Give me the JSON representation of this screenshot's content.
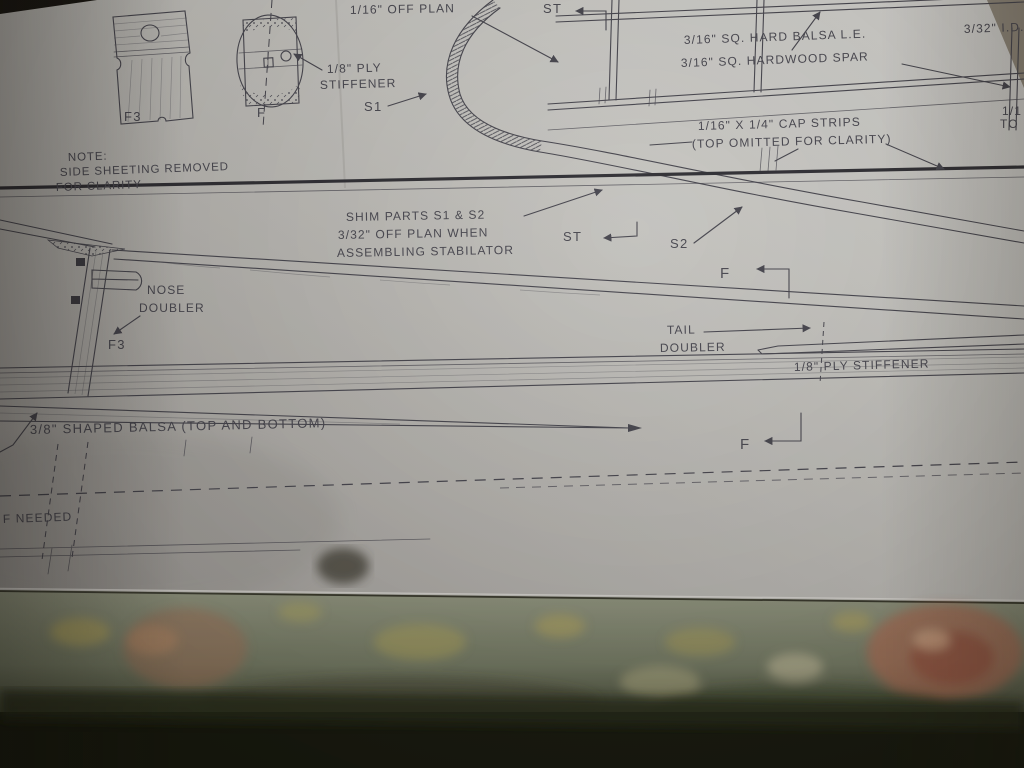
{
  "colors": {
    "paper": "#b8b6b2",
    "ink": "#45444d",
    "heavy_line": "#2b2a30",
    "tablecloth_sage": "#7f8570",
    "rose_rust": "#a5674e",
    "floral_yellow": "#b3a458",
    "background_dark": "#14160c"
  },
  "plan": {
    "parts": {
      "f3_label": "F3",
      "f_label": "F"
    },
    "annotations": {
      "shim_leading_edge": {
        "lines": [
          "SHIM LEADING EDGE",
          "1/16\" OFF PLAN"
        ]
      },
      "st_top": {
        "text": "ST"
      },
      "balsa_le": {
        "text": "3/16\" SQ. HARD BALSA L.E."
      },
      "hardwood_spar": {
        "text": "3/16\" SQ. HARDWOOD SPAR"
      },
      "id_fitting": {
        "text": "3/32\" I.D."
      },
      "edge_fragment": {
        "lines": [
          "1/1",
          "TO"
        ]
      },
      "ply_stiffener_front": {
        "lines": [
          "1/8\" PLY",
          "STIFFENER"
        ]
      },
      "s1": {
        "text": "S1"
      },
      "cap_strips": {
        "lines": [
          "1/16\" X 1/4\" CAP STRIPS",
          "(TOP OMITTED FOR CLARITY)"
        ]
      },
      "note": {
        "lines": [
          "NOTE:",
          "SIDE SHEETING REMOVED",
          "FOR CLARITY"
        ]
      },
      "shim_parts": {
        "lines": [
          "SHIM PARTS S1 & S2",
          "3/32\" OFF PLAN WHEN",
          "ASSEMBLING STABILATOR"
        ]
      },
      "st_mid": {
        "text": "ST"
      },
      "s2": {
        "text": "S2"
      },
      "nose_doubler": {
        "lines": [
          "NOSE",
          "DOUBLER"
        ]
      },
      "f3_former": {
        "text": "F3"
      },
      "tail_doubler": {
        "lines": [
          "TAIL",
          "DOUBLER"
        ]
      },
      "ply_stiffener_tail": {
        "text": "1/8\" PLY STIFFENER"
      },
      "f_section_upper": {
        "text": "F"
      },
      "f_section_lower": {
        "text": "F"
      },
      "shaped_balsa": {
        "text": "3/8\" SHAPED BALSA (TOP AND BOTTOM)"
      },
      "if_needed": {
        "text": "F NEEDED"
      }
    }
  }
}
